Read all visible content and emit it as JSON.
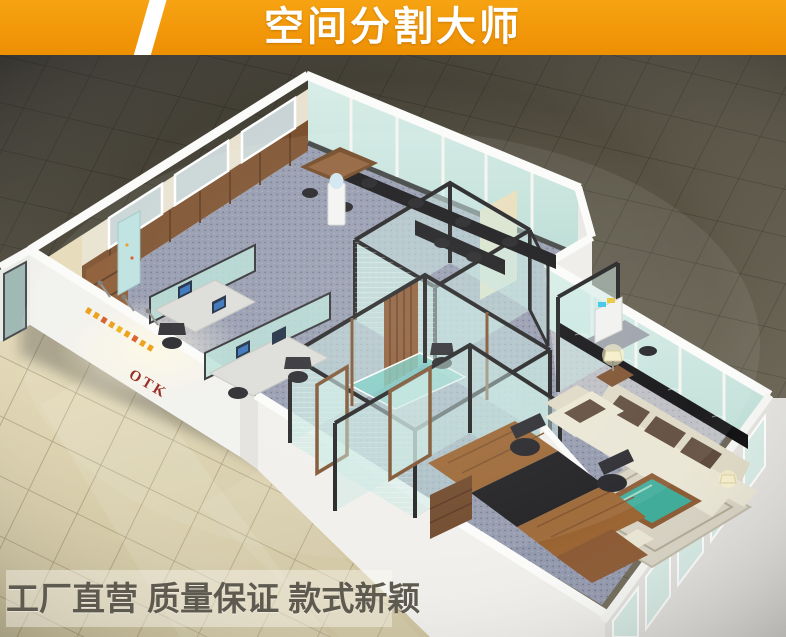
{
  "banner": {
    "title": "空间分割大师",
    "bg_color": "#F2960D",
    "slash_color": "#FFFFFF",
    "text_color": "#FFFFFF"
  },
  "footer": {
    "slogan": "工厂直营 质量保证 款式新颖",
    "text_color": "#5F5A50",
    "box_color": "rgba(252,250,244,0.42)"
  },
  "scene": {
    "type": "isometric-3d-office-interior-render",
    "logo_text": "OTK",
    "elements": [
      "tiled-dark-floor-background",
      "tiled-beige-exterior-floor",
      "white-perimeter-walls",
      "glass-curtain-walls",
      "black-frame-glass-partitions",
      "wood-slat-door",
      "conference-table-with-chairs",
      "workstation-cubicles-with-monitors",
      "water-cooler",
      "office-copier",
      "executive-l-desk",
      "office-chairs",
      "cream-sofa-set",
      "green-glass-coffee-table",
      "area-rug",
      "table-lamps",
      "logo-wall-with-spotlights"
    ],
    "palette": {
      "floor_dark": "#5B5646",
      "floor_light": "#D9CFA8",
      "wall_white": "#F1F0EC",
      "glass_teal": "#C8E6E0",
      "frame_black": "#1B1B1D",
      "wood_brown": "#8A5730",
      "carpet_blue": "#9298AC",
      "lounge_carpet": "#BBBDC2",
      "sofa_cream": "#EAE6D4",
      "cushion_brown": "#5C4738",
      "table_green": "#3BAA97",
      "logo_red": "#8F1D15",
      "logo_orange": "#EC9A0D"
    }
  }
}
